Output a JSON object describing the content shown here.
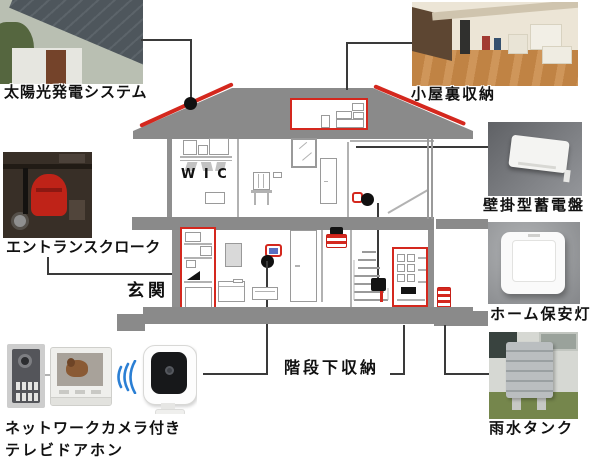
{
  "labels": {
    "solar": "太陽光発電システム",
    "attic": "小屋裏収納",
    "entrance_cloak": "エントランスクローク",
    "entrance": "玄関",
    "battery": "壁掛型蓄電盤",
    "security_light": "ホーム保安灯",
    "under_stairs": "階段下収納",
    "rain_tank": "雨水タンク",
    "network_camera": "ネットワークカメラ付き",
    "tv_doorphone": "テレビドアホン",
    "wic": "W I C"
  },
  "colors": {
    "highlight_red": "#d4281e",
    "structure_gray": "#8a8a8a",
    "connector_dark": "#3a3a3a",
    "wifi_blue": "#2b7fd4"
  }
}
